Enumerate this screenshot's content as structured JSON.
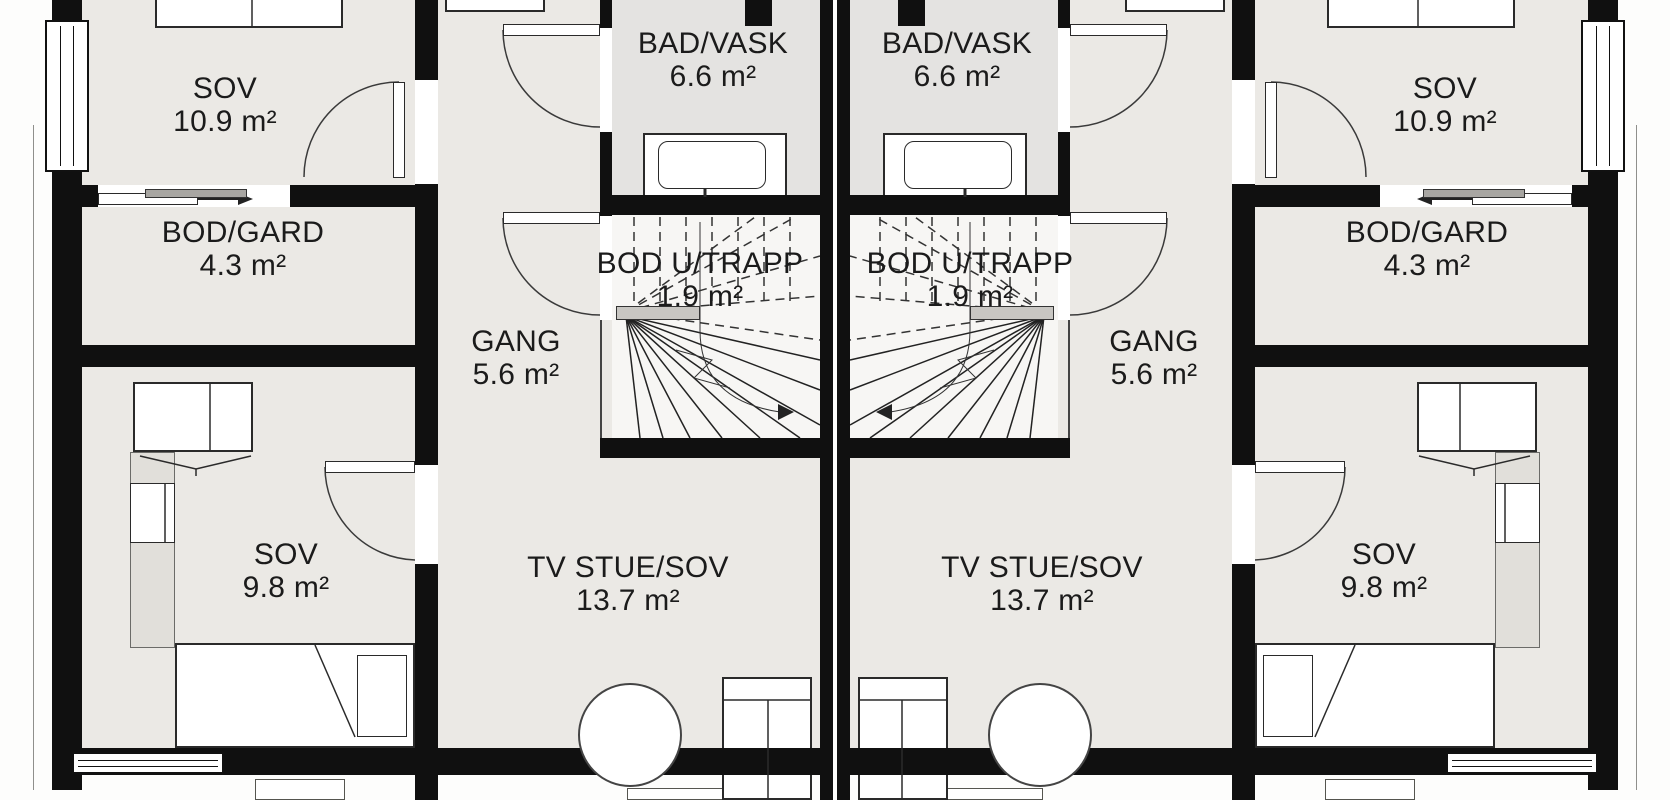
{
  "plan_title": "Duplex upper floor plan (two mirrored units)",
  "rooms": {
    "sov_top": {
      "name": "SOV",
      "area": "10.9 m²"
    },
    "bod_gard": {
      "name": "BOD/GARD",
      "area": "4.3 m²"
    },
    "bad_vask": {
      "name": "BAD/VASK",
      "area": "6.6 m²"
    },
    "gang": {
      "name": "GANG",
      "area": "5.6 m²"
    },
    "bod_u_trapp": {
      "name": "BOD U/TRAPP",
      "area": "1.9 m²"
    },
    "tv_stue": {
      "name": "TV STUE/SOV",
      "area": "13.7 m²"
    },
    "sov_bottom": {
      "name": "SOV",
      "area": "9.8 m²"
    }
  },
  "colors": {
    "wall": "#101010",
    "room_fill": "#ebe9e5",
    "bath_fill": "#e4e3e1",
    "stairs_fill": "#f7f6f4",
    "furniture_fill": "#ffffff",
    "text": "#1b1b1b"
  }
}
